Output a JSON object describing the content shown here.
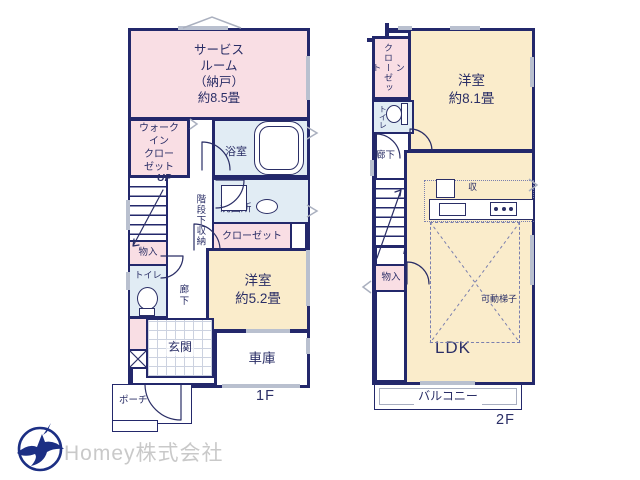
{
  "colors": {
    "wall": "#23286b",
    "room_pink": "#f9dee4",
    "room_cream": "#faeccb",
    "room_blue": "#e1ecf4",
    "line_gray": "#b9c0cf",
    "label_navy": "#2a2e66",
    "logo_navy": "#1c2f84",
    "logo_text": "#c9c9c9"
  },
  "floor1": {
    "floor_label": "1F",
    "rooms": {
      "service_room": "サービス\nルーム\n（納戸）\n約8.5畳",
      "walk_in_closet": "ウォーク\nイン\nクロー\nゼット",
      "bathroom": "浴室",
      "washroom": "洗面所",
      "under_stair_storage": "階段下収納",
      "stairs_up": "UP",
      "storage": "物入",
      "toilet": "トイレ",
      "closet": "クローゼット",
      "bedroom": "洋室\n約5.2畳",
      "hallway": "廊下",
      "entrance": "玄関",
      "garage": "車庫",
      "porch": "ポーチ"
    }
  },
  "floor2": {
    "floor_label": "2F",
    "rooms": {
      "walk_in_closet": "ウォークイン\nクローゼット",
      "bedroom": "洋室\n約8.1畳",
      "toilet": "トイレ",
      "hallway": "廊下",
      "stairs_down": "DN",
      "storage": "物入",
      "kitchen_storage": "収",
      "movable_ladder": "可動梯子",
      "ldk_label": "LDK",
      "ldk_area": "約18.1畳",
      "balcony": "バルコニー"
    }
  },
  "footer": {
    "company": "Homey株式会社"
  }
}
